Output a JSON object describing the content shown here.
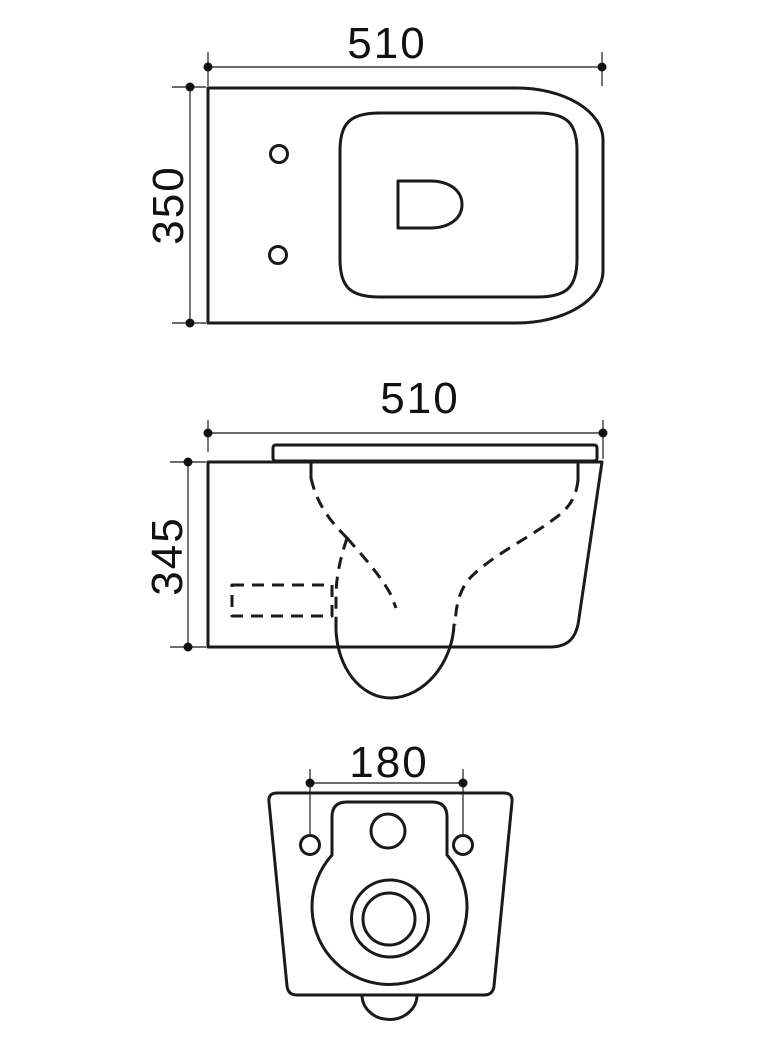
{
  "drawing": {
    "background_color": "#ffffff",
    "line_color": "#1a1a1a",
    "views": {
      "top": {
        "width_label": "510",
        "depth_label": "350"
      },
      "side": {
        "width_label": "510",
        "height_label": "345"
      },
      "rear": {
        "hole_spacing_label": "180"
      }
    }
  }
}
